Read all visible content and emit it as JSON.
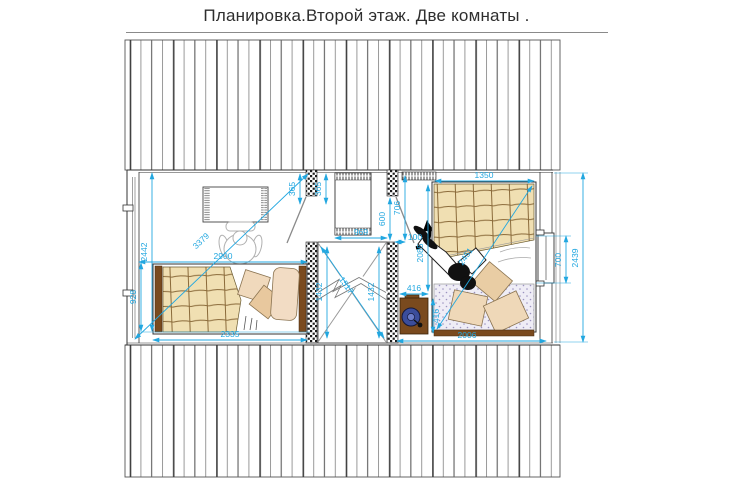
{
  "title": "Планировка.Второй этаж. Две комнаты .",
  "colors": {
    "dimension": "#22A7E0",
    "wood": "#7A4A1E",
    "blanket": "#F0DFB2",
    "pillow": "#EFD8B8",
    "machine_navy": "#3B4D9B"
  },
  "dimensions": {
    "left_room": {
      "height": "2442",
      "window_zone": "928",
      "diagonal": "3379",
      "width_top": "2900",
      "bed_width": "2335",
      "wall_seg_left": "365",
      "wall_seg_right": "365"
    },
    "closet": {
      "width": "969",
      "depth_front": "600",
      "depth_back": "706",
      "wall": "100"
    },
    "stairs": {
      "left": "1432",
      "right": "1432",
      "diagonal": "1517"
    },
    "right_room": {
      "bed_width": "1350",
      "bed_length": "2085",
      "bed_diagonal": "2451",
      "desk_width": "416",
      "desk_depth": "416",
      "room_width": "2006",
      "window_width": "700",
      "room_height": "2439"
    }
  }
}
